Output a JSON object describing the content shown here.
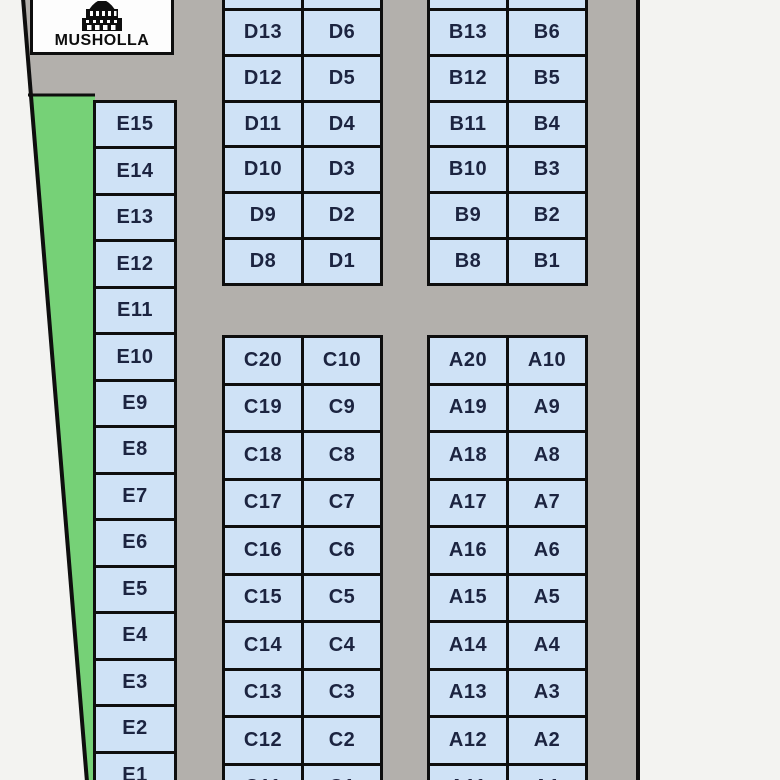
{
  "musholla": {
    "label": "MUSHOLLA"
  },
  "colors": {
    "plot_fill": "#cfe2f6",
    "green_area": "#76d177",
    "road": "#b3b0ac",
    "outside": "#f3f3f1",
    "boundary_line": "#0e0e0e",
    "plot_label": "#1c2440"
  },
  "blocks": {
    "E": {
      "rows": [
        [
          "E15"
        ],
        [
          "E14"
        ],
        [
          "E13"
        ],
        [
          "E12"
        ],
        [
          "E11"
        ],
        [
          "E10"
        ],
        [
          "E9"
        ],
        [
          "E8"
        ],
        [
          "E7"
        ],
        [
          "E6"
        ],
        [
          "E5"
        ],
        [
          "E4"
        ],
        [
          "E3"
        ],
        [
          "E2"
        ],
        [
          "E1"
        ]
      ]
    },
    "D": {
      "rows": [
        [
          "",
          ""
        ],
        [
          "D13",
          "D6"
        ],
        [
          "D12",
          "D5"
        ],
        [
          "D11",
          "D4"
        ],
        [
          "D10",
          "D3"
        ],
        [
          "D9",
          "D2"
        ],
        [
          "D8",
          "D1"
        ]
      ]
    },
    "B": {
      "rows": [
        [
          "",
          ""
        ],
        [
          "B13",
          "B6"
        ],
        [
          "B12",
          "B5"
        ],
        [
          "B11",
          "B4"
        ],
        [
          "B10",
          "B3"
        ],
        [
          "B9",
          "B2"
        ],
        [
          "B8",
          "B1"
        ]
      ]
    },
    "C": {
      "rows": [
        [
          "C20",
          "C10"
        ],
        [
          "C19",
          "C9"
        ],
        [
          "C18",
          "C8"
        ],
        [
          "C17",
          "C7"
        ],
        [
          "C16",
          "C6"
        ],
        [
          "C15",
          "C5"
        ],
        [
          "C14",
          "C4"
        ],
        [
          "C13",
          "C3"
        ],
        [
          "C12",
          "C2"
        ],
        [
          "C11",
          "C1"
        ]
      ]
    },
    "A": {
      "rows": [
        [
          "A20",
          "A10"
        ],
        [
          "A19",
          "A9"
        ],
        [
          "A18",
          "A8"
        ],
        [
          "A17",
          "A7"
        ],
        [
          "A16",
          "A6"
        ],
        [
          "A15",
          "A5"
        ],
        [
          "A14",
          "A4"
        ],
        [
          "A13",
          "A3"
        ],
        [
          "A12",
          "A2"
        ],
        [
          "A11",
          "A1"
        ]
      ]
    }
  }
}
